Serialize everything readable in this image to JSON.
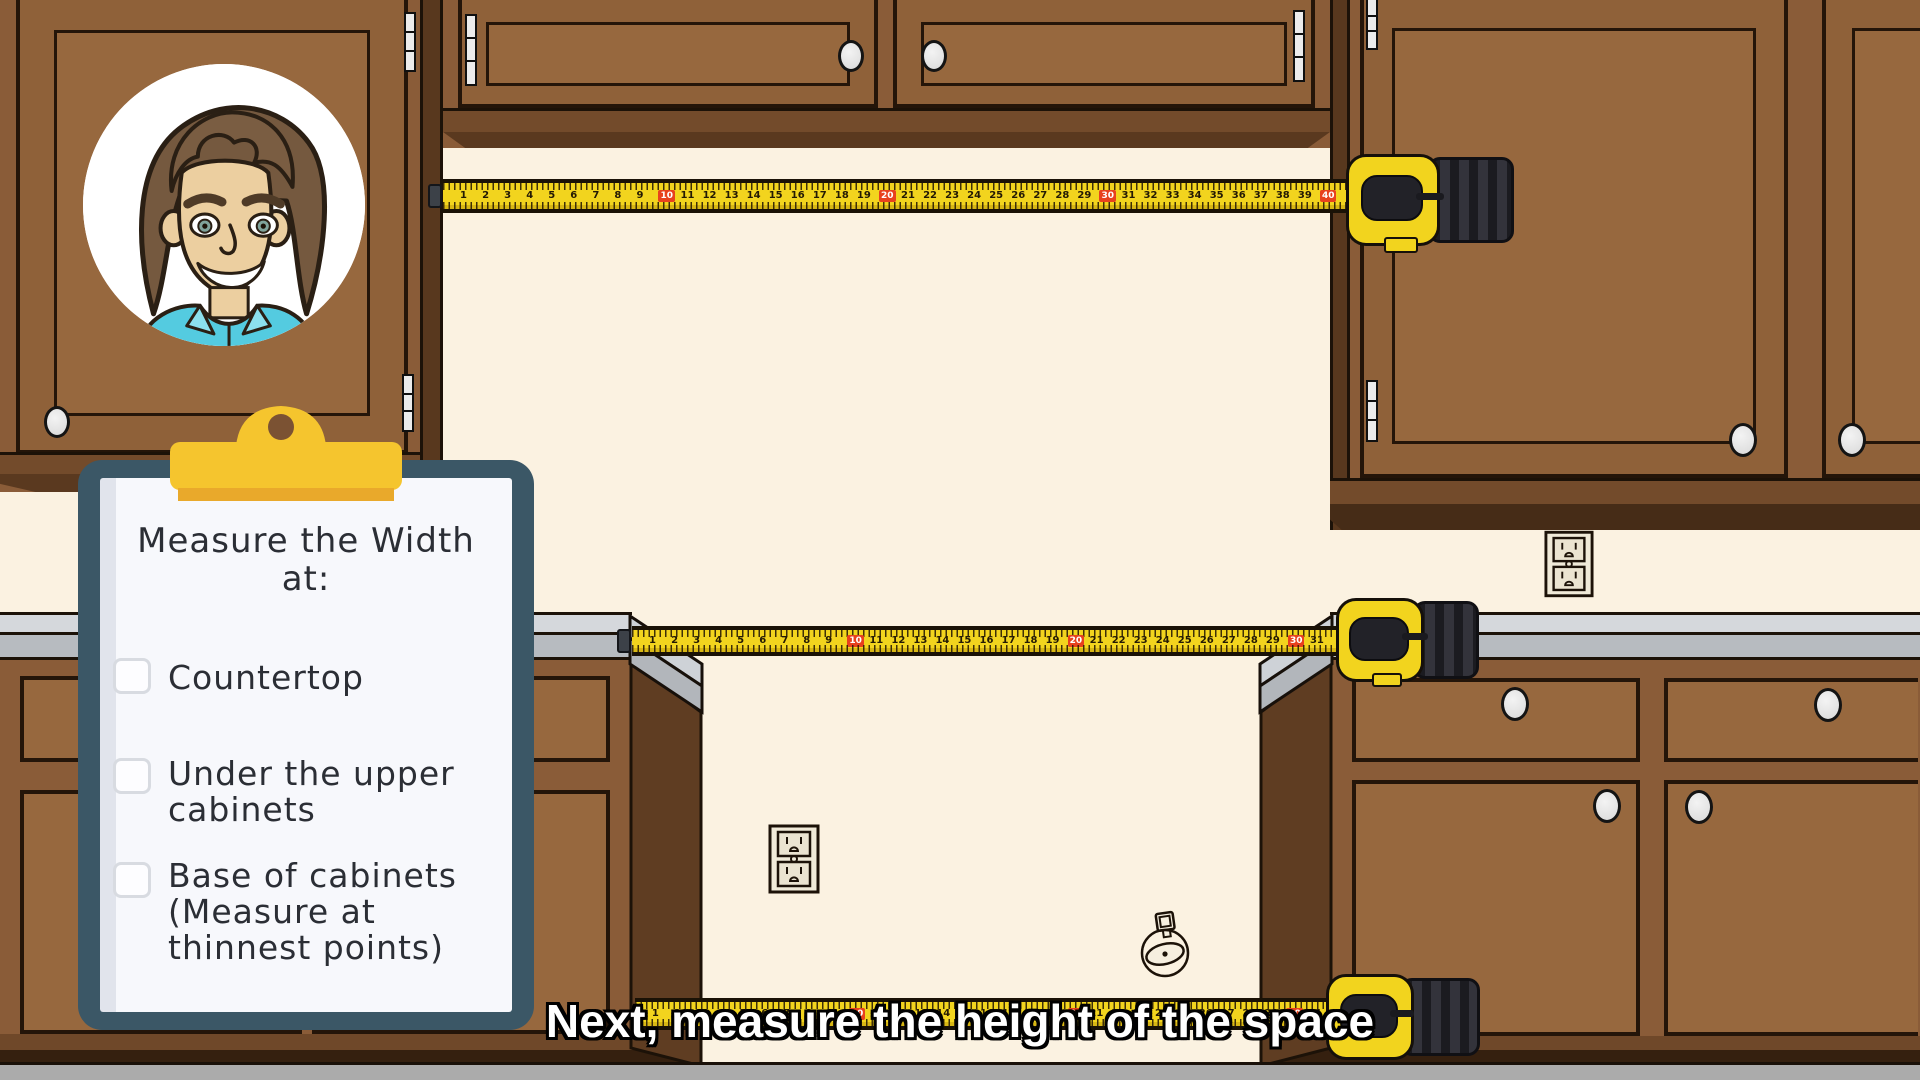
{
  "caption": {
    "text": "Next, measure the height of the space"
  },
  "clipboard": {
    "title": "Measure the Width",
    "subtitle": "at:",
    "items": [
      {
        "label": "Countertop",
        "checked": false
      },
      {
        "label": "Under the upper\ncabinets",
        "checked": false
      },
      {
        "label": "Base of cabinets\n(Measure at\nthinnest points)",
        "checked": false
      }
    ]
  },
  "tapes": {
    "red_interval": 10,
    "upper": {
      "start": 1,
      "end": 40
    },
    "middle": {
      "start": 1,
      "end": 31
    },
    "bottom": {
      "start": 1,
      "end": 31
    }
  },
  "icons": {
    "presenter-avatar": "cartoon man with brown hair and teal collared shirt",
    "clipboard-clip": "yellow clipboard clip",
    "tape-measure": "yellow tape measure with black grip",
    "power-outlet": "duplex wall outlet",
    "gas-connection": "capped gas line fitting on wall",
    "checkbox": "empty checkbox"
  },
  "colors": {
    "wall": "#fbf2e1",
    "cabinet_face": "#8a5c38",
    "cabinet_panel": "#97683e",
    "cabinet_shadow": "#5d3a1f",
    "countertop_gray": "#c9cdd2",
    "floor_gray": "#ababab",
    "tape_yellow": "#f2d41e",
    "tape_marker_red": "#e8411d",
    "clipboard_board_teal": "#3b5766",
    "clip_yellow": "#f5c52e",
    "caption_text": "#ffffff",
    "shirt_teal": "#54cbe0"
  }
}
